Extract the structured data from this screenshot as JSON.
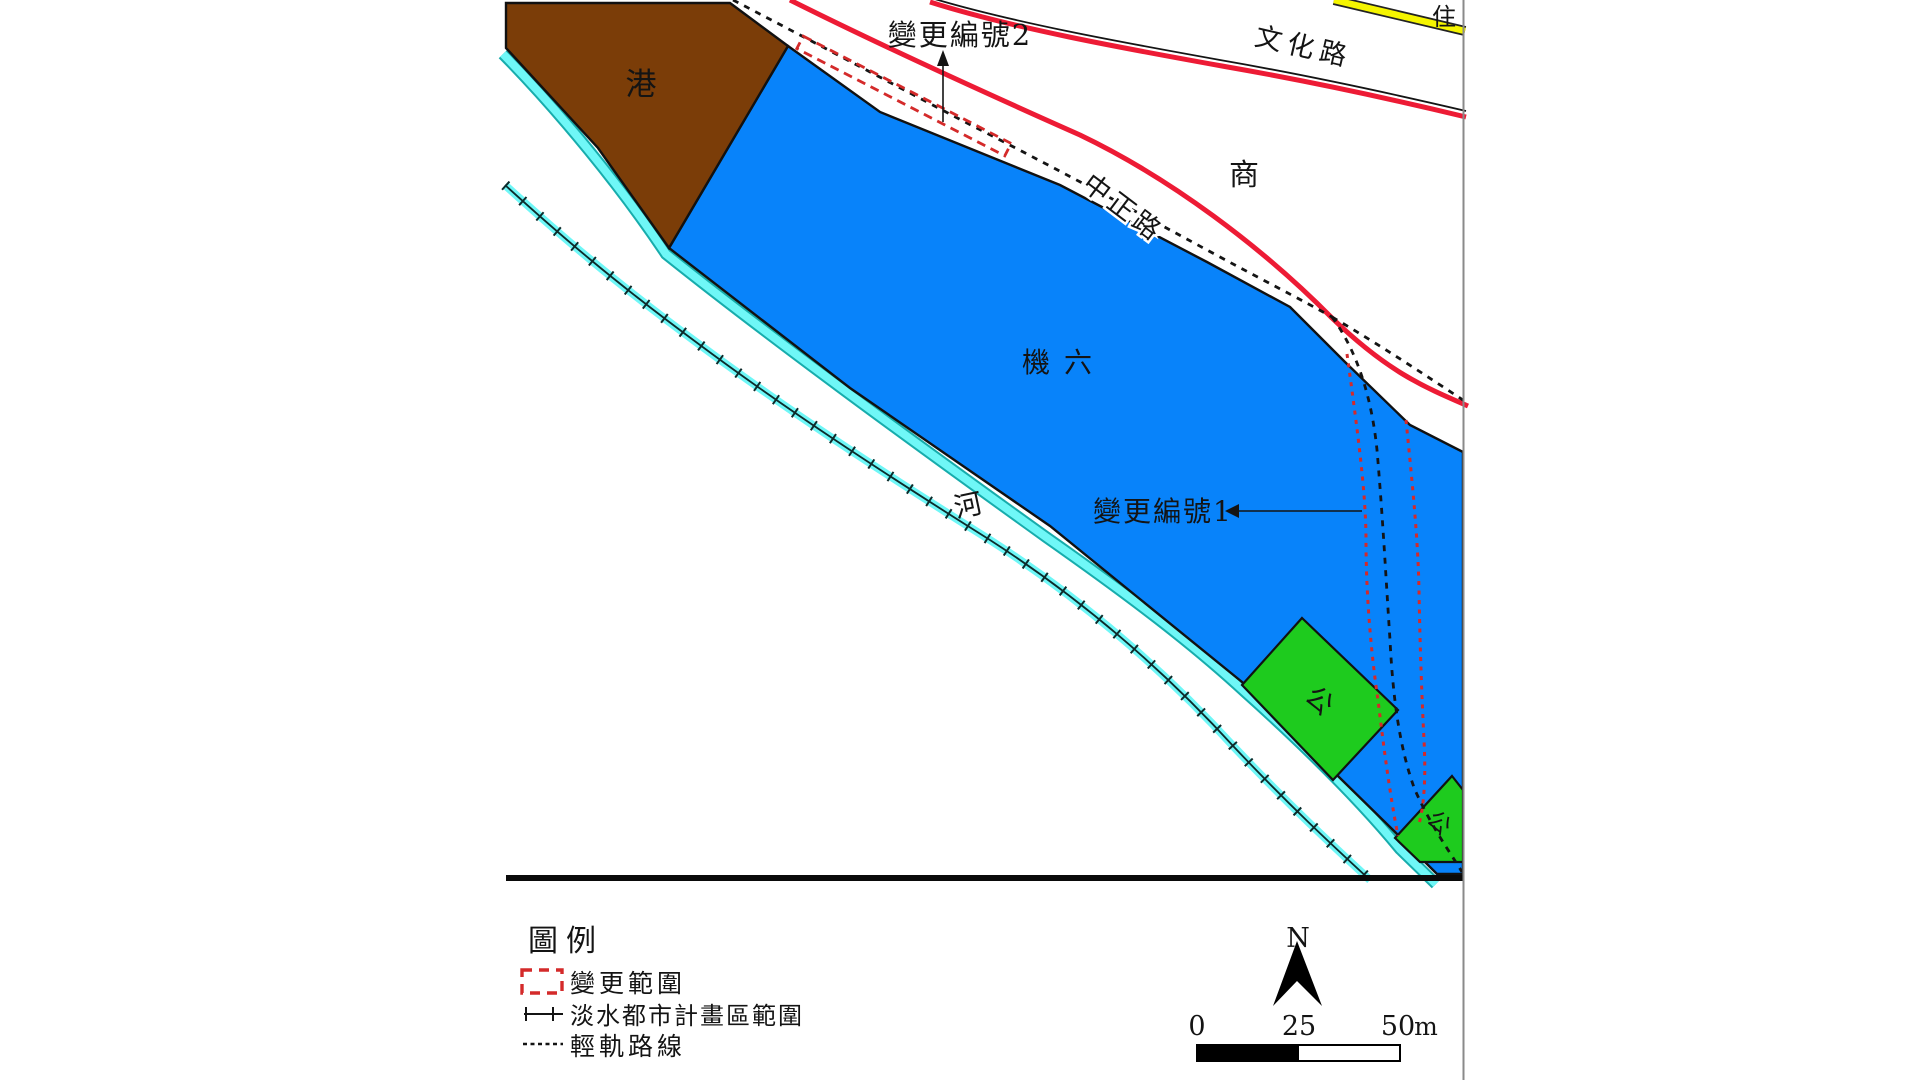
{
  "map": {
    "area_labels": {
      "port": "港",
      "airport": "機六",
      "river": "河",
      "commercial": "商",
      "residential": "住",
      "park1": "公",
      "park2": "公"
    },
    "road_labels": {
      "zhongzheng": "中正路",
      "wenhua": "文化路"
    },
    "annotations": {
      "change2": "變更編號2",
      "change1": "變更編號1"
    }
  },
  "legend": {
    "title": "圖例",
    "items": [
      {
        "symbol": "red-dashed-rectangle",
        "label": "變更範圍"
      },
      {
        "symbol": "tick-line",
        "label": "淡水都市計畫區範圍"
      },
      {
        "symbol": "dashed-line",
        "label": "輕軌路線"
      }
    ]
  },
  "north": {
    "label": "N"
  },
  "scale_bar": {
    "tick0": "0",
    "tick25": "25",
    "tick50": "50",
    "unit": "m"
  },
  "colors": {
    "blue": "#0883FA",
    "brown": "#7B3D08",
    "green": "#1ECB1E",
    "cyan": "#6FF7F7",
    "cyan_dark": "#17ACAC",
    "road_red": "#ED1B35",
    "change_red": "#D42A2A",
    "yellow": "#F5F500",
    "border_gray": "#8A8A8A",
    "ink": "#141414"
  }
}
